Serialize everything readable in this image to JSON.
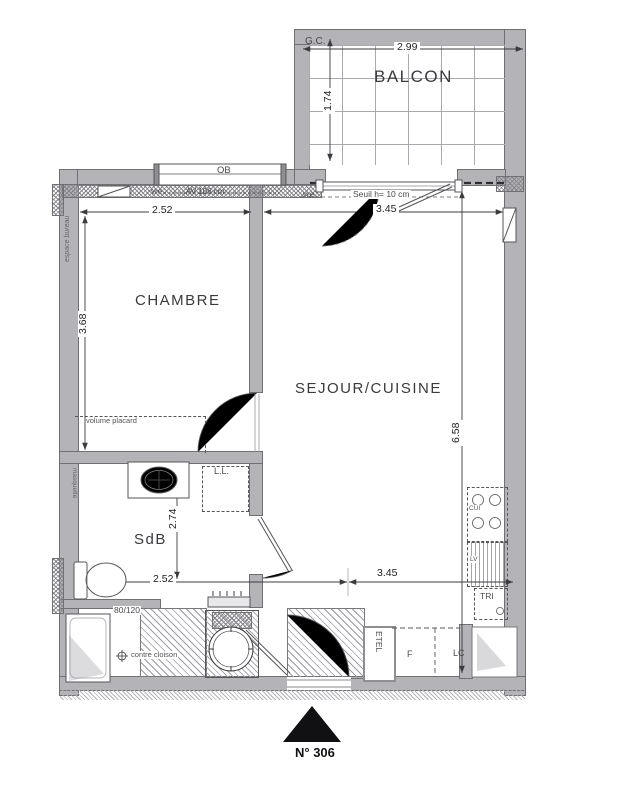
{
  "title": {
    "unit": "N° 306"
  },
  "rooms": {
    "balcony": "BALCON",
    "bedroom": "CHAMBRE",
    "living": "SEJOUR/CUISINE",
    "bath": "SdB"
  },
  "dims": {
    "balcony_w": "2.99",
    "balcony_d": "1.74",
    "bedroom_w": "2.52",
    "bedroom_d": "3.68",
    "living_w_top": "3.45",
    "living_d": "6.58",
    "bath_d": "2.74",
    "bath_w": "2.52",
    "hall_w": "3.45"
  },
  "notes": {
    "gc": "G.C.",
    "ob": "OB",
    "vre_bedroom": "vre",
    "vre_living": "vre",
    "sill": "AV 106 cm",
    "threshold": "Seuil h= 10 cm",
    "desk": "espace bureau",
    "closet": "volume placard",
    "wall_finish": "masquette",
    "washer": "L.L.",
    "shower": "80/120",
    "partition": "contre cloison",
    "elec": "ETEL",
    "fridge": "F",
    "lc": "LC",
    "sort": "TRI",
    "hob": "CUI",
    "dishwasher": "LV"
  }
}
